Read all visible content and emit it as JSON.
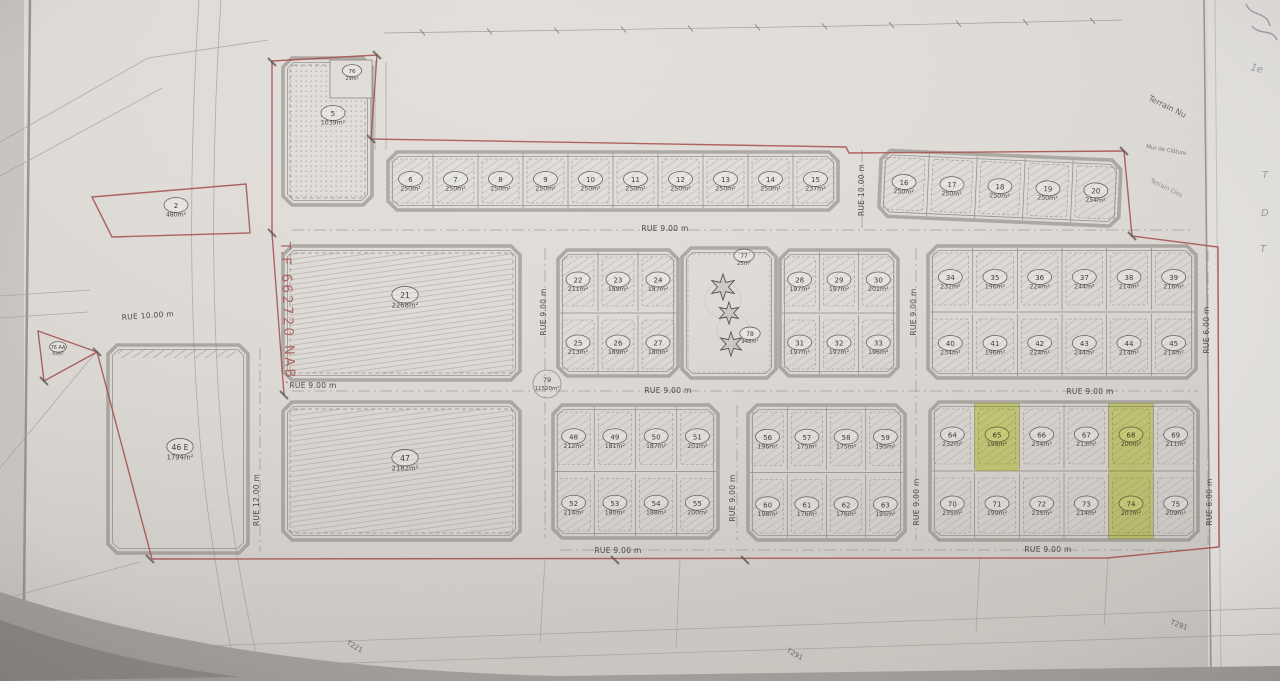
{
  "streets": {
    "rue9": "RUE 9.00 m",
    "rue10": "RUE 10.00 m",
    "rue12": "RUE 12.00 m",
    "rue6": "RUE 6.00 m"
  },
  "annotations": {
    "title_ref": "T.F 662720 NAB.",
    "terrain_nu": "Terrain Nu",
    "mur_cloture": "Mur de Clôture",
    "terrain_clos": "Terrain Clos",
    "t221": "T221",
    "t291": "T291",
    "hand_1e": "1e",
    "hand_T": "T",
    "hand_D": "D"
  },
  "highlight": {
    "color": "#d7e43c",
    "lots": [
      "65",
      "68",
      "74"
    ]
  },
  "lots": {
    "2": {
      "num": "2",
      "area": "480m²"
    },
    "5": {
      "num": "5",
      "area": "1039m²"
    },
    "6": {
      "num": "6",
      "area": "250m²"
    },
    "7": {
      "num": "7",
      "area": "250m²"
    },
    "8": {
      "num": "8",
      "area": "250m²"
    },
    "9": {
      "num": "9",
      "area": "250m²"
    },
    "10": {
      "num": "10",
      "area": "250m²"
    },
    "11": {
      "num": "11",
      "area": "250m²"
    },
    "12": {
      "num": "12",
      "area": "250m²"
    },
    "13": {
      "num": "13",
      "area": "250m²"
    },
    "14": {
      "num": "14",
      "area": "250m²"
    },
    "15": {
      "num": "15",
      "area": "237m²"
    },
    "16": {
      "num": "16",
      "area": "250m²"
    },
    "17": {
      "num": "17",
      "area": "250m²"
    },
    "18": {
      "num": "18",
      "area": "250m²"
    },
    "19": {
      "num": "19",
      "area": "250m²"
    },
    "20": {
      "num": "20",
      "area": "254m²"
    },
    "21": {
      "num": "21",
      "area": "2268m²"
    },
    "22": {
      "num": "22",
      "area": "211m²"
    },
    "23": {
      "num": "23",
      "area": "189m²"
    },
    "24": {
      "num": "24",
      "area": "187m²"
    },
    "25": {
      "num": "25",
      "area": "213m²"
    },
    "26": {
      "num": "26",
      "area": "189m²"
    },
    "27": {
      "num": "27",
      "area": "180m²"
    },
    "28": {
      "num": "28",
      "area": "197m²"
    },
    "29": {
      "num": "29",
      "area": "197m²"
    },
    "30": {
      "num": "30",
      "area": "201m²"
    },
    "31": {
      "num": "31",
      "area": "197m²"
    },
    "32": {
      "num": "32",
      "area": "197m²"
    },
    "33": {
      "num": "33",
      "area": "196m²"
    },
    "34": {
      "num": "34",
      "area": "232m²"
    },
    "35": {
      "num": "35",
      "area": "196m²"
    },
    "36": {
      "num": "36",
      "area": "224m²"
    },
    "37": {
      "num": "37",
      "area": "244m²"
    },
    "38": {
      "num": "38",
      "area": "214m²"
    },
    "39": {
      "num": "39",
      "area": "216m²"
    },
    "40": {
      "num": "40",
      "area": "234m²"
    },
    "41": {
      "num": "41",
      "area": "196m²"
    },
    "42": {
      "num": "42",
      "area": "224m²"
    },
    "43": {
      "num": "43",
      "area": "244m²"
    },
    "44": {
      "num": "44",
      "area": "214m²"
    },
    "45": {
      "num": "45",
      "area": "214m²"
    },
    "46E": {
      "num": "46 E",
      "area": "1794m²"
    },
    "47": {
      "num": "47",
      "area": "2182m²"
    },
    "48": {
      "num": "48",
      "area": "212m²"
    },
    "49": {
      "num": "49",
      "area": "181m²"
    },
    "50": {
      "num": "50",
      "area": "187m²"
    },
    "51": {
      "num": "51",
      "area": "201m²"
    },
    "52": {
      "num": "52",
      "area": "214m²"
    },
    "53": {
      "num": "53",
      "area": "180m²"
    },
    "54": {
      "num": "54",
      "area": "188m²"
    },
    "55": {
      "num": "55",
      "area": "200m²"
    },
    "56": {
      "num": "56",
      "area": "196m²"
    },
    "57": {
      "num": "57",
      "area": "175m²"
    },
    "58": {
      "num": "58",
      "area": "175m²"
    },
    "59": {
      "num": "59",
      "area": "195m²"
    },
    "60": {
      "num": "60",
      "area": "198m²"
    },
    "61": {
      "num": "61",
      "area": "176m²"
    },
    "62": {
      "num": "62",
      "area": "176m²"
    },
    "63": {
      "num": "63",
      "area": "195m²"
    },
    "64": {
      "num": "64",
      "area": "232m²"
    },
    "65": {
      "num": "65",
      "area": "198m²"
    },
    "66": {
      "num": "66",
      "area": "234m²"
    },
    "67": {
      "num": "67",
      "area": "213m²"
    },
    "68": {
      "num": "68",
      "area": "200m²"
    },
    "69": {
      "num": "69",
      "area": "211m²"
    },
    "70": {
      "num": "70",
      "area": "235m²"
    },
    "71": {
      "num": "71",
      "area": "199m²"
    },
    "72": {
      "num": "72",
      "area": "235m²"
    },
    "73": {
      "num": "73",
      "area": "214m²"
    },
    "74": {
      "num": "74",
      "area": "207m²"
    },
    "75": {
      "num": "75",
      "area": "209m²"
    },
    "76": {
      "num": "76",
      "area": "29m²"
    },
    "76AA": {
      "num": "76 AA",
      "area": "43m²"
    },
    "77": {
      "num": "77",
      "area": "25m²"
    },
    "78": {
      "num": "78",
      "area": "948m²"
    },
    "79": {
      "num": "79",
      "area": "11520m²"
    }
  }
}
